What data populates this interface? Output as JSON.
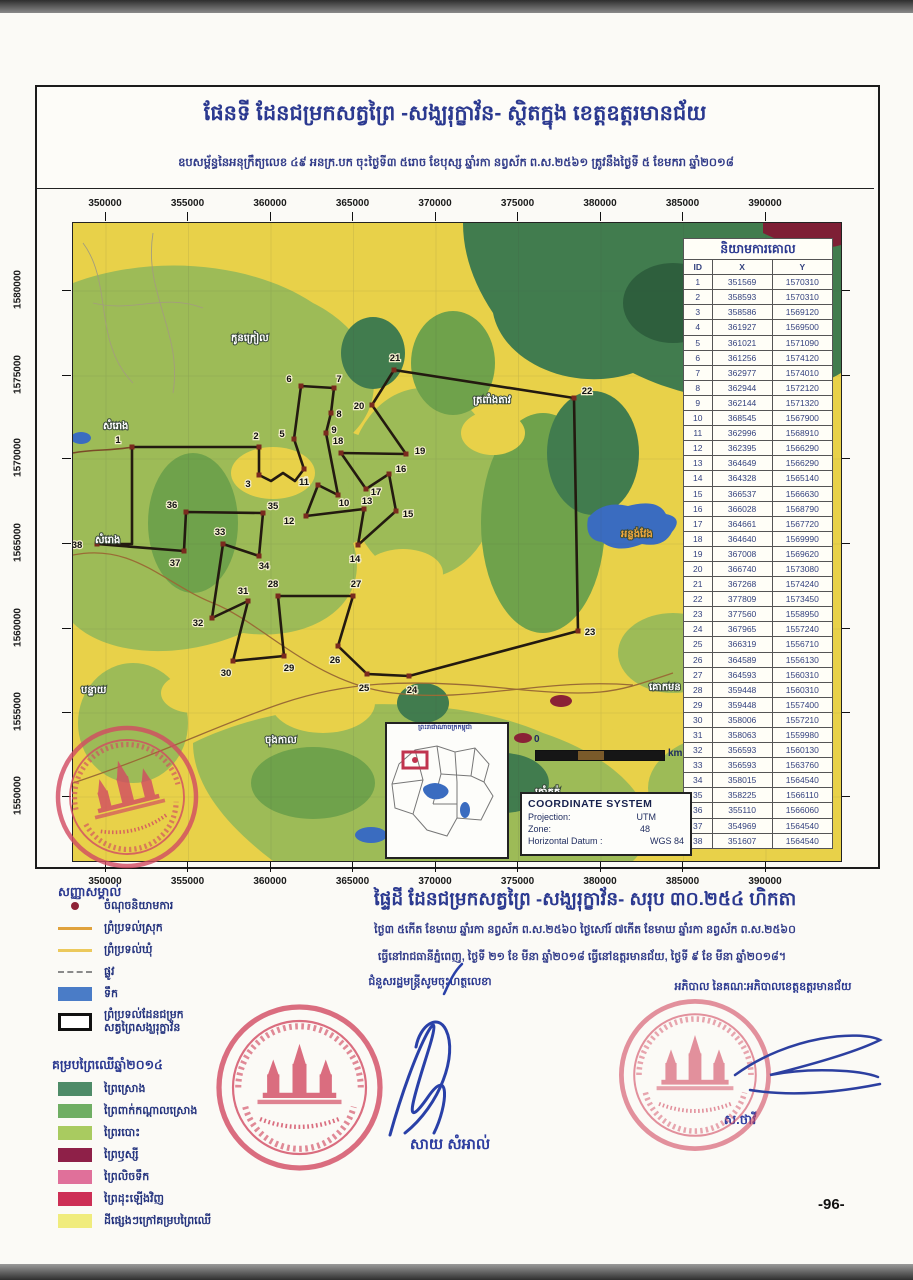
{
  "header": {
    "title": "ផែនទី ដែនជម្រកសត្វព្រៃ -សង្ឃរុក្ខាវ័ន- ស្ថិតក្នុង ខេត្តឧត្តរមានជ័យ",
    "subtitle": "ឧបសម្ព័ន្ធនៃអនុក្រឹត្យលេខ ៤៩ អនក្រ.បក ចុះថ្ងៃទី៣ ៥រោច ខែបុស្ស ឆ្នាំរកា នព្វស័ក ព.ស.២៥៦១ ត្រូវនឹងថ្ងៃទី ៥ ខែមករា ឆ្នាំ២០១៨"
  },
  "axes": {
    "x_labels": [
      "350000",
      "355000",
      "360000",
      "365000",
      "370000",
      "375000",
      "380000",
      "385000",
      "390000"
    ],
    "y_labels": [
      "1580000",
      "1575000",
      "1570000",
      "1565000",
      "1560000",
      "1555000",
      "1550000"
    ]
  },
  "coords_table": {
    "title": "និយាមការគោល",
    "columns": [
      "ID",
      "X",
      "Y"
    ],
    "rows": [
      [
        "1",
        "351569",
        "1570310"
      ],
      [
        "2",
        "358593",
        "1570310"
      ],
      [
        "3",
        "358586",
        "1569120"
      ],
      [
        "4",
        "361927",
        "1569500"
      ],
      [
        "5",
        "361021",
        "1571090"
      ],
      [
        "6",
        "361256",
        "1574120"
      ],
      [
        "7",
        "362977",
        "1574010"
      ],
      [
        "8",
        "362944",
        "1572120"
      ],
      [
        "9",
        "362144",
        "1571320"
      ],
      [
        "10",
        "368545",
        "1567900"
      ],
      [
        "11",
        "362996",
        "1568910"
      ],
      [
        "12",
        "362395",
        "1566290"
      ],
      [
        "13",
        "364649",
        "1566290"
      ],
      [
        "14",
        "364328",
        "1565140"
      ],
      [
        "15",
        "366537",
        "1566630"
      ],
      [
        "16",
        "366028",
        "1568790"
      ],
      [
        "17",
        "364661",
        "1567720"
      ],
      [
        "18",
        "364640",
        "1569990"
      ],
      [
        "19",
        "367008",
        "1569620"
      ],
      [
        "20",
        "366740",
        "1573080"
      ],
      [
        "21",
        "367268",
        "1574240"
      ],
      [
        "22",
        "377809",
        "1573450"
      ],
      [
        "23",
        "377560",
        "1558950"
      ],
      [
        "24",
        "367965",
        "1557240"
      ],
      [
        "25",
        "366319",
        "1556710"
      ],
      [
        "26",
        "364589",
        "1556130"
      ],
      [
        "27",
        "364593",
        "1560310"
      ],
      [
        "28",
        "359448",
        "1560310"
      ],
      [
        "29",
        "359448",
        "1557400"
      ],
      [
        "30",
        "358006",
        "1557210"
      ],
      [
        "31",
        "358063",
        "1559980"
      ],
      [
        "32",
        "356593",
        "1560130"
      ],
      [
        "33",
        "356593",
        "1563760"
      ],
      [
        "34",
        "358015",
        "1564540"
      ],
      [
        "35",
        "358225",
        "1566110"
      ],
      [
        "36",
        "355110",
        "1566060"
      ],
      [
        "37",
        "354969",
        "1564540"
      ],
      [
        "38",
        "351607",
        "1564540"
      ]
    ]
  },
  "map": {
    "place_labels": [
      {
        "text": "កូនក្រៀល",
        "x": 158,
        "y": 118,
        "color": "#ffffff"
      },
      {
        "text": "សំរោង",
        "x": 30,
        "y": 206,
        "color": "#ffffff"
      },
      {
        "text": "សំរោង",
        "x": 22,
        "y": 320,
        "color": "#ffffff"
      },
      {
        "text": "ត្រពាំងតាវ",
        "x": 400,
        "y": 180,
        "color": "#ffffff"
      },
      {
        "text": "អន្លង់វែង",
        "x": 548,
        "y": 314,
        "color": "#f0a83c"
      },
      {
        "text": "បន្ទាយ",
        "x": 8,
        "y": 470,
        "color": "#ffffff"
      },
      {
        "text": "ចុងកាល",
        "x": 192,
        "y": 520,
        "color": "#ffffff"
      },
      {
        "text": "គោកមន",
        "x": 576,
        "y": 467,
        "color": "#ffffff"
      },
      {
        "text": "ត្រាំកក់",
        "x": 462,
        "y": 572,
        "color": "#ffffff"
      }
    ],
    "points": [
      {
        "n": "1",
        "x": 59,
        "y": 224,
        "dx": -14,
        "dy": -7
      },
      {
        "n": "2",
        "x": 186,
        "y": 224,
        "dx": -3,
        "dy": -11
      },
      {
        "n": "3",
        "x": 186,
        "y": 252,
        "dx": -11,
        "dy": 9
      },
      {
        "n": "4",
        "x": 231,
        "y": 246,
        "dx": 1,
        "dy": 12
      },
      {
        "n": "5",
        "x": 221,
        "y": 216,
        "dx": -12,
        "dy": -5
      },
      {
        "n": "6",
        "x": 228,
        "y": 163,
        "dx": -12,
        "dy": -7
      },
      {
        "n": "7",
        "x": 261,
        "y": 165,
        "dx": 5,
        "dy": -9
      },
      {
        "n": "8",
        "x": 258,
        "y": 190,
        "dx": 8,
        "dy": 1
      },
      {
        "n": "9",
        "x": 253,
        "y": 210,
        "dx": 8,
        "dy": -3
      },
      {
        "n": "10",
        "x": 265,
        "y": 272,
        "dx": 6,
        "dy": 8
      },
      {
        "n": "11",
        "x": 245,
        "y": 262,
        "dx": -14,
        "dy": -3
      },
      {
        "n": "12",
        "x": 233,
        "y": 293,
        "dx": -17,
        "dy": 5
      },
      {
        "n": "13",
        "x": 291,
        "y": 286,
        "dx": 3,
        "dy": -8
      },
      {
        "n": "14",
        "x": 285,
        "y": 322,
        "dx": -3,
        "dy": 14
      },
      {
        "n": "15",
        "x": 323,
        "y": 288,
        "dx": 12,
        "dy": 3
      },
      {
        "n": "16",
        "x": 316,
        "y": 251,
        "dx": 12,
        "dy": -5
      },
      {
        "n": "17",
        "x": 293,
        "y": 266,
        "dx": 10,
        "dy": 3
      },
      {
        "n": "18",
        "x": 268,
        "y": 230,
        "dx": -3,
        "dy": -12
      },
      {
        "n": "19",
        "x": 333,
        "y": 231,
        "dx": 14,
        "dy": -3
      },
      {
        "n": "20",
        "x": 299,
        "y": 182,
        "dx": -13,
        "dy": 1
      },
      {
        "n": "21",
        "x": 321,
        "y": 147,
        "dx": 1,
        "dy": -12
      },
      {
        "n": "22",
        "x": 501,
        "y": 175,
        "dx": 13,
        "dy": -7
      },
      {
        "n": "23",
        "x": 505,
        "y": 408,
        "dx": 12,
        "dy": 1
      },
      {
        "n": "24",
        "x": 336,
        "y": 453,
        "dx": 3,
        "dy": 14
      },
      {
        "n": "25",
        "x": 294,
        "y": 451,
        "dx": -3,
        "dy": 14
      },
      {
        "n": "26",
        "x": 265,
        "y": 423,
        "dx": -3,
        "dy": 14
      },
      {
        "n": "27",
        "x": 280,
        "y": 373,
        "dx": 3,
        "dy": -12
      },
      {
        "n": "28",
        "x": 205,
        "y": 373,
        "dx": -5,
        "dy": -12
      },
      {
        "n": "29",
        "x": 211,
        "y": 433,
        "dx": 5,
        "dy": 12
      },
      {
        "n": "30",
        "x": 160,
        "y": 438,
        "dx": -7,
        "dy": 12
      },
      {
        "n": "31",
        "x": 175,
        "y": 378,
        "dx": -5,
        "dy": -10
      },
      {
        "n": "32",
        "x": 139,
        "y": 395,
        "dx": -14,
        "dy": 5
      },
      {
        "n": "33",
        "x": 150,
        "y": 321,
        "dx": -3,
        "dy": -12
      },
      {
        "n": "34",
        "x": 186,
        "y": 333,
        "dx": 5,
        "dy": 10
      },
      {
        "n": "35",
        "x": 190,
        "y": 290,
        "dx": 10,
        "dy": -7
      },
      {
        "n": "36",
        "x": 113,
        "y": 289,
        "dx": -14,
        "dy": -7
      },
      {
        "n": "37",
        "x": 111,
        "y": 328,
        "dx": -9,
        "dy": 12
      },
      {
        "n": "38",
        "x": 24,
        "y": 321,
        "dx": -20,
        "dy": 1
      }
    ],
    "inset_title": "ព្រះរាជាណាចក្រកម្ពុជា",
    "scale_zero": "0",
    "scale_unit": "km"
  },
  "coordinate_system": {
    "title": "COORDINATE SYSTEM",
    "projection_label": "Projection:",
    "projection": "UTM",
    "zone_label": "Zone:",
    "zone": "48",
    "datum_label": "Horizontal Datum :",
    "datum": "WGS 84"
  },
  "legend": {
    "title": "សញ្ញាសម្គាល់",
    "items": [
      {
        "label": "ចំណុចនិយាមការ",
        "symbol": "dot",
        "color": "#8e2236"
      },
      {
        "label": "ព្រំប្រទល់ស្រុក",
        "symbol": "line",
        "color": "#e0a23c"
      },
      {
        "label": "ព្រំប្រទល់ឃុំ",
        "symbol": "line",
        "color": "#ecc95c"
      },
      {
        "label": "ផ្លូវ",
        "symbol": "dash",
        "color": "#8a8a8a"
      },
      {
        "label": "ទឹក",
        "symbol": "rect",
        "color": "#4a7cc7"
      },
      {
        "label": "ព្រំប្រទល់ដែនជម្រក",
        "label2": "សត្វព្រៃសង្ឃរុក្ខាវ័ន",
        "symbol": "outline",
        "color": "#111111"
      }
    ],
    "forest": {
      "title": "គម្របព្រៃឈើឆ្នាំ២០១៤",
      "items": [
        {
          "label": "ព្រៃស្រោង",
          "color": "#4e8b68"
        },
        {
          "label": "ព្រៃពាក់កណ្តាលស្រោង",
          "color": "#6fae63"
        },
        {
          "label": "ព្រៃរបោះ",
          "color": "#a9cb60"
        },
        {
          "label": "ព្រៃឫស្សី",
          "color": "#8e2048"
        },
        {
          "label": "ព្រៃលិចទឹក",
          "color": "#e0709a"
        },
        {
          "label": "ព្រៃដុះឡើងវិញ",
          "color": "#cd2f55"
        },
        {
          "label": "ដីផ្សេងៗក្រៅគម្របព្រៃឈើ",
          "color": "#f0ec7d"
        }
      ]
    }
  },
  "footer": {
    "area_title": "ផ្ទៃដី ដែនជម្រកសត្វព្រៃ -សង្ឃរុក្ខាវ័ន- សរុប ៣០.២៥៤ ហិកតា",
    "date_line1": "ថ្ងៃ៣ ៥កើត ខែមាឃ ឆ្នាំរកា នព្វស័ក ព.ស.២៥៦០ ថ្ងៃសៅរ៍ ៧កើត ខែមាឃ ឆ្នាំរកា នព្វស័ក ព.ស.២៥៦០",
    "date_line2": "ធ្វើនៅរាជធានីភ្នំពេញ, ថ្ងៃទី ២១ ខែ មីនា ឆ្នាំ២០១៨ ធ្វើនៅឧត្តរមានជ័យ, ថ្ងៃទី ៩ ខែ មីនា ឆ្នាំ២០១៨។",
    "left_role": "ជំនួសរដ្ឋមន្ត្រីសូមចុះហត្ថលេខា",
    "right_role": "អភិបាល នៃគណៈអភិបាលខេត្តឧត្តរមានជ័យ",
    "left_name": "សាយ សំអាល់",
    "right_name": "ស.ថាវី"
  },
  "page": {
    "number": "-96-"
  }
}
